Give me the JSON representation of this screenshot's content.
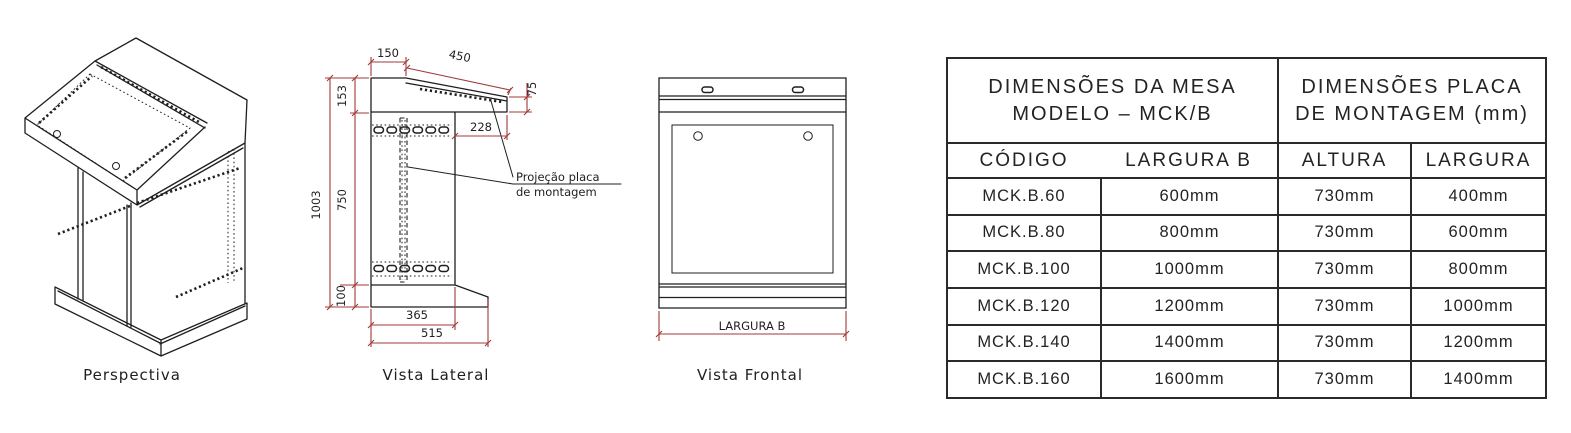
{
  "colors": {
    "line": "#1f1f1f",
    "dimension": "#a23a3a",
    "table_line": "#2a2a2a",
    "background": "#ffffff"
  },
  "views": {
    "perspectiva": {
      "label": "Perspectiva"
    },
    "lateral": {
      "label": "Vista Lateral",
      "dims": {
        "top_flat": "150",
        "slope": "450",
        "lip_height": "75",
        "head_height": "153",
        "plate_offset": "228",
        "total_height": "1003",
        "body_height": "750",
        "base_height": "100",
        "body_depth": "365",
        "base_depth": "515"
      },
      "annotation": {
        "line1": "Projeção placa",
        "line2": "de montagem"
      }
    },
    "frontal": {
      "label": "Vista Frontal",
      "width_dim": "LARGURA B"
    }
  },
  "table": {
    "group_headers": [
      {
        "line1": "DIMENSÕES DA MESA",
        "line2": "MODELO – MCK/B"
      },
      {
        "line1": "DIMENSÕES PLACA",
        "line2": "DE MONTAGEM (mm)"
      }
    ],
    "columns": [
      "CÓDIGO",
      "LARGURA B",
      "ALTURA",
      "LARGURA"
    ],
    "rows": [
      [
        "MCK.B.60",
        "600mm",
        "730mm",
        "400mm"
      ],
      [
        "MCK.B.80",
        "800mm",
        "730mm",
        "600mm"
      ],
      [
        "MCK.B.100",
        "1000mm",
        "730mm",
        "800mm"
      ],
      [
        "MCK.B.120",
        "1200mm",
        "730mm",
        "1000mm"
      ],
      [
        "MCK.B.140",
        "1400mm",
        "730mm",
        "1200mm"
      ],
      [
        "MCK.B.160",
        "1600mm",
        "730mm",
        "1400mm"
      ]
    ]
  }
}
